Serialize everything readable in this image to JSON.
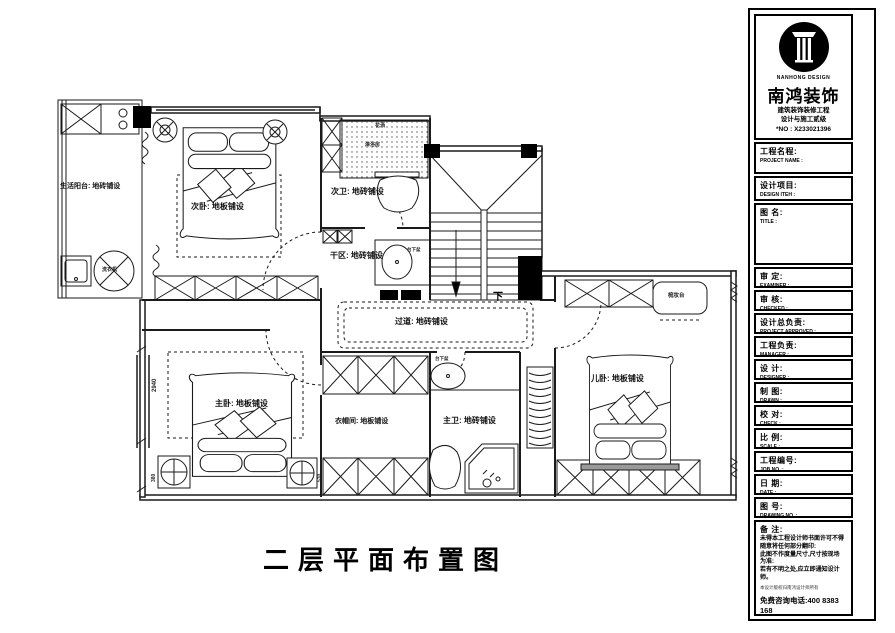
{
  "page": {
    "drawing_title": "二层平面布置图"
  },
  "company": {
    "logo_text": "NANHONG DESIGN",
    "name": "南鸿装饰",
    "qualification_line1": "建筑装饰装修工程",
    "qualification_line2": "设计与施工贰级",
    "license_no": "*NO : X233021396"
  },
  "titleblock": {
    "project_name_zh": "工程名程:",
    "project_name_en": "PROJECT NAME :",
    "design_item_zh": "设计项目:",
    "design_item_en": "DESIGN ITEH :",
    "drawing_name_zh": "图 名:",
    "drawing_name_en": "TITLE :",
    "fields": [
      {
        "zh": "审 定:",
        "en": "EXAMINER :"
      },
      {
        "zh": "审 核:",
        "en": "CHECKED :"
      },
      {
        "zh": "设计总负责:",
        "en": "PROJECT APPROVED :"
      },
      {
        "zh": "工程负责:",
        "en": "MANAGER :"
      },
      {
        "zh": "设 计:",
        "en": "DESIGNER :"
      },
      {
        "zh": "制 图:",
        "en": "DRAWN :"
      },
      {
        "zh": "校 对:",
        "en": "CHECK :"
      },
      {
        "zh": "比 例:",
        "en": "SCALE :"
      },
      {
        "zh": "工程编号:",
        "en": "JOB NO. :"
      },
      {
        "zh": "日 期:",
        "en": "DATE :"
      },
      {
        "zh": "图 号:",
        "en": "DRAWING NO. :"
      }
    ],
    "remarks_title": "备 注:",
    "remarks_lines": [
      "未得本工程设计师书面许可不得",
      "随意将任何部分翻印:",
      "此图不作度量尺寸,尺寸按现场",
      "为准:",
      "若有不明之处,应立即通知设计",
      "师。"
    ],
    "fine_print": "本设计版权归南鸿设计师所有",
    "hotline": "免费咨询电话:400 8383 168"
  },
  "plan": {
    "labels": [
      {
        "text": "生活阳台: 地砖铺设"
      },
      {
        "text": "次卧: 地板铺设"
      },
      {
        "text": "次卫: 地砖铺设"
      },
      {
        "text": "干区: 地砖铺设"
      },
      {
        "text": "过道: 地砖铺设"
      },
      {
        "text": "主卧: 地板铺设"
      },
      {
        "text": "衣帽间: 地板铺设"
      },
      {
        "text": "主卫: 地砖铺设"
      },
      {
        "text": "儿卧: 地板铺设"
      },
      {
        "text": "洗衣机"
      },
      {
        "text": "下"
      },
      {
        "text": "梳妆台"
      },
      {
        "text": "花洒"
      },
      {
        "text": "淋浴房"
      },
      {
        "text": "台下盆"
      },
      {
        "text": "台下盆"
      },
      {
        "text": "2940"
      },
      {
        "text": "380"
      },
      {
        "text": "530"
      }
    ]
  }
}
